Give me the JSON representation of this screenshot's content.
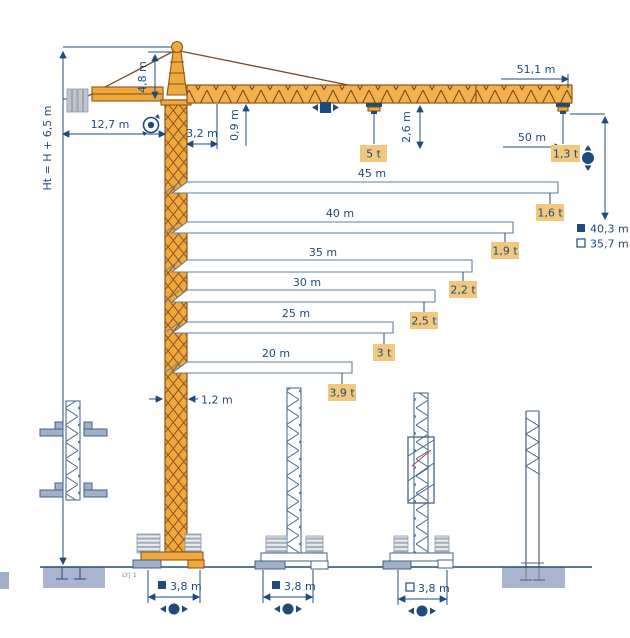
{
  "diagram_title": "Tower crane dimension and load diagram",
  "model": "LYJ 1",
  "colors": {
    "crane_yellow": "#F0A93C",
    "outline_brown": "#8A5420",
    "dim_navy": "#1D4C7C",
    "label_bg": "#F3C77D",
    "steel_blue": "#9FB0C8",
    "concrete": "#A9B4CE"
  },
  "dimensions": {
    "total_height": "Ht = H + 6,5 m",
    "counter_jib_radius": "12,7 m",
    "tower_head_height": "4,8 m",
    "min_trolley_radius": "3,2 m",
    "jib_section_height": "0,9 m",
    "trolley_hook_drop": "2,6 m",
    "jib_length": "51,1 m",
    "max_load": "5 t",
    "tip_radius": "50 m",
    "tip_load": "1,3 t",
    "mast_width": "1,2 m"
  },
  "load_chart": [
    {
      "length": "45 m",
      "capacity": "1,6 t"
    },
    {
      "length": "40 m",
      "capacity": "1,9 t"
    },
    {
      "length": "35 m",
      "capacity": "2,2 t"
    },
    {
      "length": "30 m",
      "capacity": "2,5 t"
    },
    {
      "length": "25 m",
      "capacity": "3 t"
    },
    {
      "length": "20 m",
      "capacity": "3,9 t"
    }
  ],
  "legend": [
    {
      "marker": "filled-square",
      "value": "40,3 m"
    },
    {
      "marker": "open-square",
      "value": "35,7 m"
    }
  ],
  "bases": [
    {
      "marker": "filled-square",
      "gauge": "3,8 m"
    },
    {
      "marker": "filled-square",
      "gauge": "3,8 m"
    },
    {
      "marker": "open-square",
      "gauge": "3,8 m"
    }
  ],
  "chart_data": {
    "type": "bar",
    "orientation": "horizontal",
    "title": "Tower crane load chart",
    "categories": [
      "45 m",
      "40 m",
      "35 m",
      "30 m",
      "25 m",
      "20 m"
    ],
    "values": [
      1.6,
      1.9,
      2.2,
      2.5,
      3.0,
      3.9
    ],
    "unit": "t",
    "jib_length_m": 51.1,
    "load_at_50_m_t": 1.3,
    "max_load_t": 5.0,
    "hook_height_m": {
      "filled_square": 40.3,
      "open_square": 35.7
    },
    "counter_jib_radius_m": 12.7,
    "tower_head_height_m": 4.8,
    "min_trolley_radius_m": 3.2,
    "jib_section_height_m": 0.9,
    "trolley_hook_drop_m": 2.6,
    "mast_width_m": 1.2,
    "base_gauge_m": 3.8,
    "height_formula": "Ht = H + 6,5 m"
  }
}
